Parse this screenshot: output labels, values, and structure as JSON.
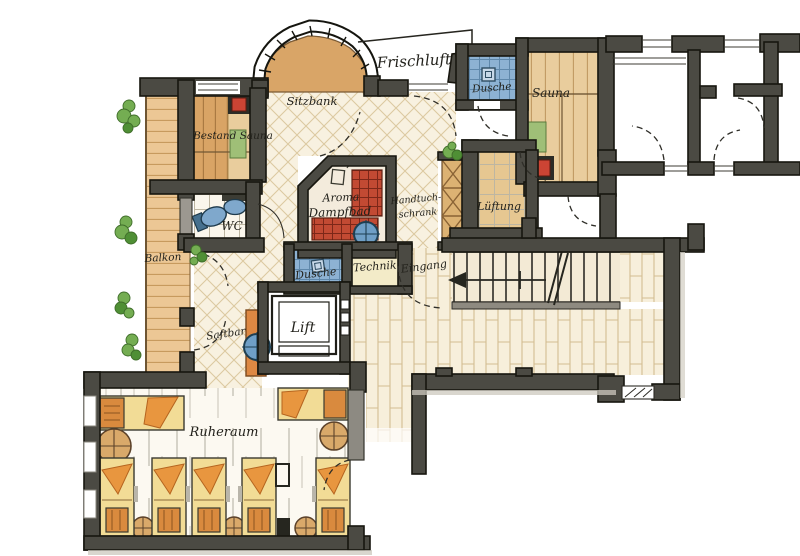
{
  "title": "Wellness-Bereich Grundriss",
  "labels": {
    "frischluft": "Frischluft",
    "sitzbank": "Sitzbank",
    "bestand_sauna": "Bestand Sauna",
    "dusche_top": "Dusche",
    "sauna": "Sauna",
    "wc": "WC",
    "aroma_line1": "Aroma",
    "aroma_line2": "Dampfbad",
    "handtuch_line1": "Handtuch-",
    "handtuch_line2": "schrank",
    "lueftung": "Lüftung",
    "balkon": "Balkon",
    "dusche_lower": "Dusche",
    "technik": "Technik",
    "eingang": "Eingang",
    "lift": "Lift",
    "saftbar": "Saftbar",
    "ruheraum": "Ruheraum"
  },
  "colors": {
    "wall": "#4b4a43",
    "wood_deck": "#ecc795",
    "wood_sauna": "#d9a465",
    "floor_lattice": "#f8f1e0",
    "floor_bond": "#f7efdb",
    "red_tile": "#c24a33",
    "blue_fixture": "#7fa8cc",
    "green_plant": "#74ad52",
    "orange_lounger": "#e8963f",
    "yellow_lounger": "#f2dc96",
    "technik_floor": "#f3ebc8"
  }
}
